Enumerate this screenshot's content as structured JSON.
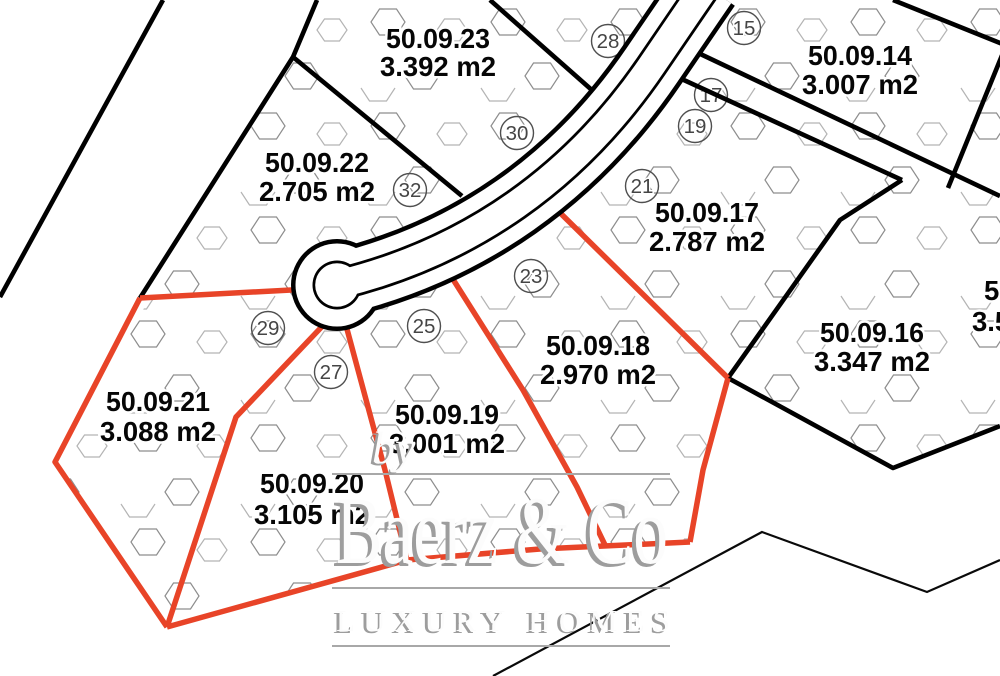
{
  "map": {
    "parcels": [
      {
        "id": "50.09.23",
        "area": "3.392 m2"
      },
      {
        "id": "50.09.22",
        "area": "2.705 m2"
      },
      {
        "id": "50.09.14",
        "area": "3.007 m2"
      },
      {
        "id": "50.09.17",
        "area": "2.787 m2"
      },
      {
        "id": "50.09.16",
        "area": "3.347 m2"
      },
      {
        "id": "50.09.18",
        "area": "2.970 m2"
      },
      {
        "id": "50.09.19",
        "area": "3.001 m2"
      },
      {
        "id": "50.09.20",
        "area": "3.105 m2"
      },
      {
        "id": "50.09.21",
        "area": "3.088 m2"
      },
      {
        "id": "50",
        "area": "3.5"
      }
    ],
    "markers": [
      "15",
      "17",
      "19",
      "21",
      "23",
      "25",
      "27",
      "28",
      "29",
      "30",
      "32"
    ],
    "colors": {
      "highlight": "#e84428",
      "boundary": "#000000",
      "hexagon": "#8d8d8d",
      "watermark_gray": "#a8a8a8"
    }
  },
  "watermark": {
    "prefix": "by",
    "brand": "Baerz & Co",
    "tagline": "LUXURY HOMES"
  }
}
